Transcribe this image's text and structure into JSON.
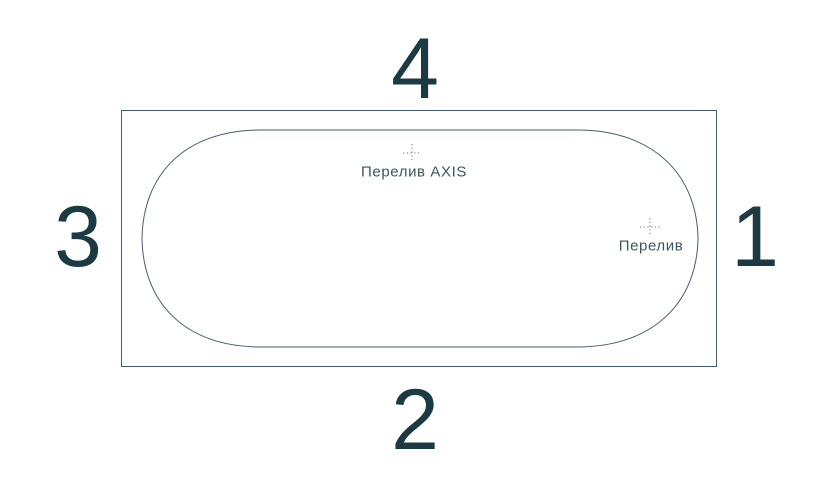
{
  "diagram": {
    "type": "bathtub-top-view",
    "side_numbers": {
      "top": "4",
      "right": "1",
      "bottom": "2",
      "left": "3"
    },
    "markers": [
      {
        "label": "Перелив AXIS",
        "icon": "crosshair-icon"
      },
      {
        "label": "Перелив",
        "icon": "crosshair-icon"
      }
    ],
    "colors": {
      "outline": "#44606a",
      "number_text": "#1b3a43",
      "label_text": "#3c575f",
      "crosshair": "#6b8289",
      "background": "#ffffff"
    }
  }
}
